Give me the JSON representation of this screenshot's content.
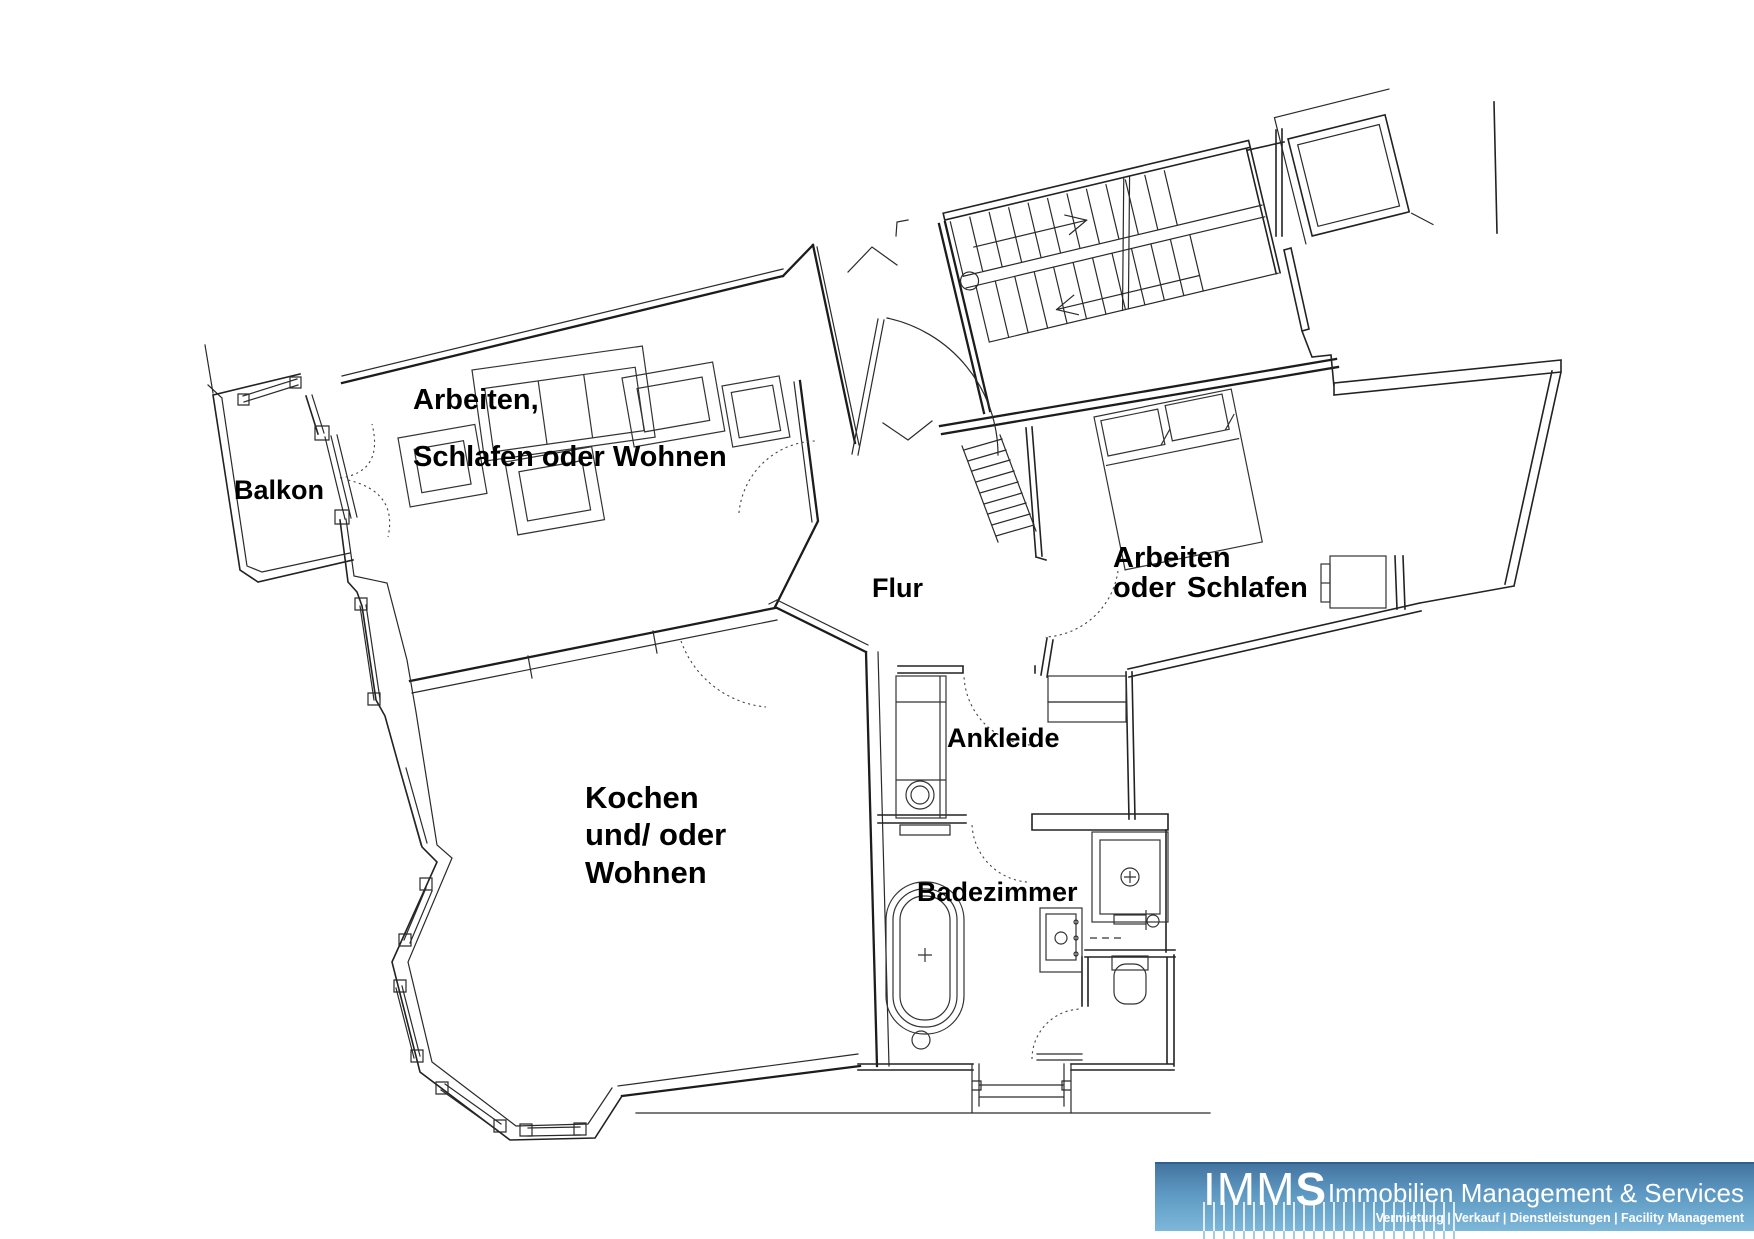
{
  "plan": {
    "background": "#ffffff",
    "line_color": "#1c1c1c",
    "labels": {
      "balkon": "Balkon",
      "room_top_line1": "Arbeiten,",
      "room_top_line2": "Schlafen oder Wohnen",
      "flur": "Flur",
      "room_right_line1": "Arbeiten",
      "room_right_line2a": "oder",
      "room_right_line2b": "Schlafen",
      "ankleide": "Ankleide",
      "kitchen_line1": "Kochen",
      "kitchen_line2": "und/ oder",
      "kitchen_line3": "Wohnen",
      "badezimmer": "Badezimmer"
    }
  },
  "logo": {
    "brand_light": "IMM",
    "brand_bold": "S",
    "title": "Immobilien Management & Services",
    "subtitle": "Vermietung | Verkauf | Dienstleistungen | Facility Management",
    "banner_top_color": "#44749f",
    "banner_mid_color": "#5b96c0",
    "banner_bottom_color": "#7db8da"
  }
}
